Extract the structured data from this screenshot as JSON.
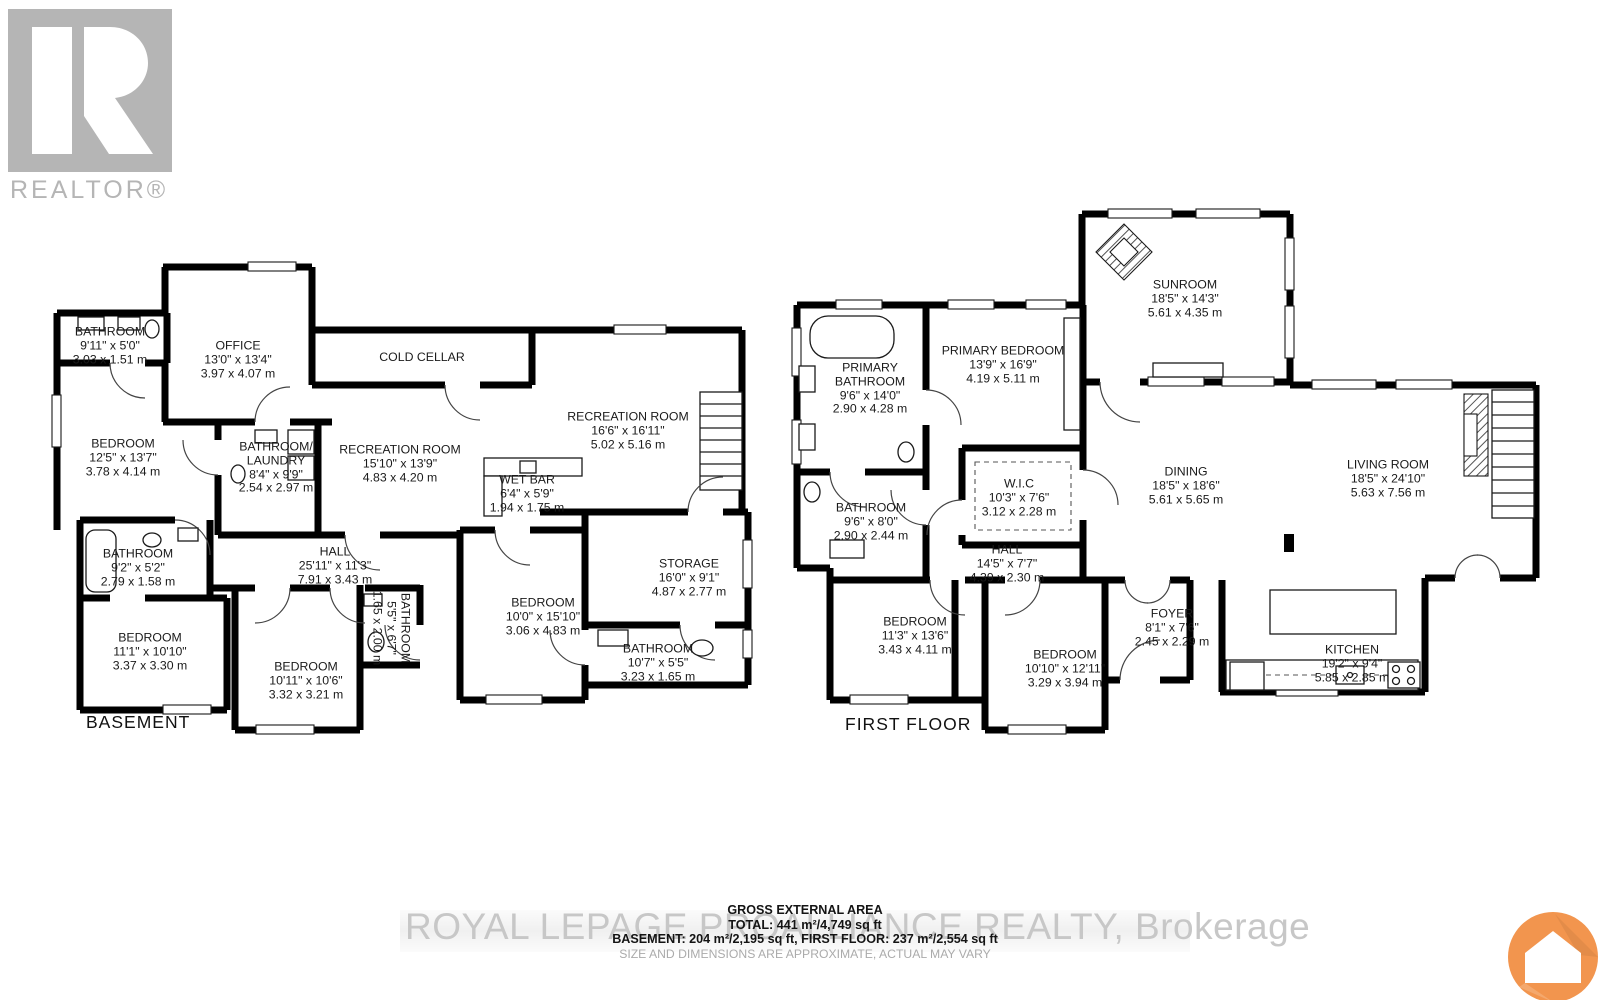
{
  "branding": {
    "realtor_logo_text": "REALTOR®",
    "watermark": "ROYAL LEPAGE PROALLIANCE REALTY, Brokerage"
  },
  "footer": {
    "title": "GROSS EXTERNAL AREA",
    "total": "TOTAL: 441 m²/4,749 sq ft",
    "breakdown": "BASEMENT: 204 m²/2,195 sq ft, FIRST FLOOR: 237 m²/2,554 sq ft",
    "disclaimer": "SIZE AND DIMENSIONS ARE APPROXIMATE, ACTUAL MAY VARY"
  },
  "colors": {
    "wall": "#000000",
    "label_text": "#1a1a1a",
    "logo_gray": "#b5b5b5",
    "watermark_gray": "#c7c7c7",
    "app_logo_orange": "#f2954e"
  },
  "floors": [
    {
      "id": "basement",
      "label": "BASEMENT",
      "rooms": [
        {
          "name": "BATHROOM",
          "imperial": "9'11\" x 5'0\"",
          "metric": "3.03 x 1.51 m",
          "x": 110,
          "y": 346
        },
        {
          "name": "OFFICE",
          "imperial": "13'0\" x 13'4\"",
          "metric": "3.97 x 4.07 m",
          "x": 238,
          "y": 360
        },
        {
          "name": "COLD CELLAR",
          "x": 422,
          "y": 358
        },
        {
          "name": "RECREATION ROOM",
          "imperial": "16'6\" x 16'11\"",
          "metric": "5.02 x 5.16 m",
          "x": 628,
          "y": 431
        },
        {
          "name": "RECREATION ROOM",
          "imperial": "15'10\" x 13'9\"",
          "metric": "4.83 x 4.20 m",
          "x": 400,
          "y": 464
        },
        {
          "name_lines": [
            "BATHROOM/",
            "LAUNDRY"
          ],
          "imperial": "8'4\" x 9'9\"",
          "metric": "2.54 x 2.97 m",
          "x": 276,
          "y": 468
        },
        {
          "name": "BEDROOM",
          "imperial": "12'5\" x 13'7\"",
          "metric": "3.78 x 4.14 m",
          "x": 123,
          "y": 458
        },
        {
          "name": "WET BAR",
          "imperial": "6'4\" x 5'9\"",
          "metric": "1.94 x 1.75 m",
          "x": 527,
          "y": 494
        },
        {
          "name": "HALL",
          "imperial": "25'11\" x 11'3\"",
          "metric": "7.91 x 3.43 m",
          "x": 335,
          "y": 566
        },
        {
          "name": "BATHROOM",
          "imperial": "9'2\" x 5'2\"",
          "metric": "2.79 x 1.58 m",
          "x": 138,
          "y": 568
        },
        {
          "name": "STORAGE",
          "imperial": "16'0\" x 9'1\"",
          "metric": "4.87 x 2.77 m",
          "x": 689,
          "y": 578
        },
        {
          "name": "BEDROOM",
          "imperial": "11'1\" x 10'10\"",
          "metric": "3.37 x 3.30 m",
          "x": 150,
          "y": 652
        },
        {
          "name": "BEDROOM",
          "imperial": "10'11\" x 10'6\"",
          "metric": "3.32 x 3.21 m",
          "x": 306,
          "y": 681
        },
        {
          "name": "BATHROOM",
          "imperial": "5'5\" x 6'7\"",
          "metric": "1.65 x 2.00 m",
          "x": 391,
          "y": 628,
          "rotated": true
        },
        {
          "name": "BEDROOM",
          "imperial": "10'0\" x 15'10\"",
          "metric": "3.06 x 4.83 m",
          "x": 543,
          "y": 617
        },
        {
          "name": "BATHROOM",
          "imperial": "10'7\" x 5'5\"",
          "metric": "3.23 x 1.65 m",
          "x": 658,
          "y": 663
        }
      ]
    },
    {
      "id": "first-floor",
      "label": "FIRST FLOOR",
      "rooms": [
        {
          "name": "SUNROOM",
          "imperial": "18'5\" x 14'3\"",
          "metric": "5.61 x 4.35 m",
          "x": 1185,
          "y": 299
        },
        {
          "name": "PRIMARY BEDROOM",
          "imperial": "13'9\" x 16'9\"",
          "metric": "4.19 x 5.11 m",
          "x": 1003,
          "y": 365
        },
        {
          "name_lines": [
            "PRIMARY",
            "BATHROOM"
          ],
          "imperial": "9'6\" x 14'0\"",
          "metric": "2.90 x 4.28 m",
          "x": 870,
          "y": 389
        },
        {
          "name": "W.I.C",
          "imperial": "10'3\" x 7'6\"",
          "metric": "3.12 x 2.28 m",
          "x": 1019,
          "y": 498
        },
        {
          "name": "BATHROOM",
          "imperial": "9'6\" x 8'0\"",
          "metric": "2.90 x 2.44 m",
          "x": 871,
          "y": 522
        },
        {
          "name": "HALL",
          "imperial": "14'5\" x 7'7\"",
          "metric": "4.39 x 2.30 m",
          "x": 1007,
          "y": 564
        },
        {
          "name": "DINING",
          "imperial": "18'5\" x 18'6\"",
          "metric": "5.61 x 5.65 m",
          "x": 1186,
          "y": 486
        },
        {
          "name": "LIVING ROOM",
          "imperial": "18'5\" x 24'10\"",
          "metric": "5.63 x 7.56 m",
          "x": 1388,
          "y": 479
        },
        {
          "name": "BEDROOM",
          "imperial": "11'3\" x 13'6\"",
          "metric": "3.43 x 4.11 m",
          "x": 915,
          "y": 636
        },
        {
          "name": "BEDROOM",
          "imperial": "10'10\" x 12'11\"",
          "metric": "3.29 x 3.94 m",
          "x": 1065,
          "y": 669
        },
        {
          "name": "FOYER",
          "imperial": "8'1\" x 7'6\"",
          "metric": "2.45 x 2.29 m",
          "x": 1172,
          "y": 628
        },
        {
          "name": "KITCHEN",
          "imperial": "19'2\" x 9'4\"",
          "metric": "5.85 x 2.85 m",
          "x": 1352,
          "y": 664
        }
      ]
    }
  ]
}
